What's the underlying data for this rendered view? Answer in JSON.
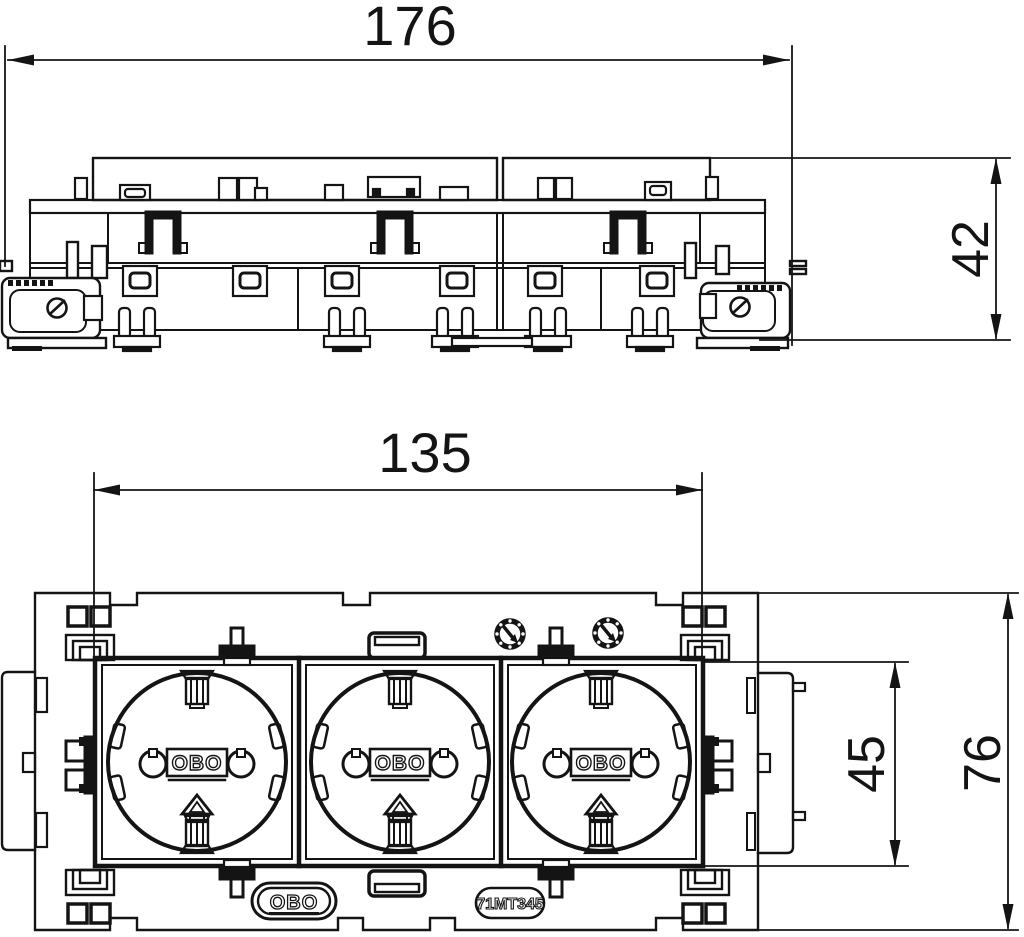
{
  "drawing": {
    "background_color": "#ffffff",
    "line_color": "#141414",
    "dimensions": {
      "overall_width": "176",
      "overall_height": "42",
      "insert_width": "135",
      "insert_height": "45",
      "front_height": "76"
    },
    "labels": {
      "socket_logo": "OBO",
      "brand_badge": "OBO",
      "part_number": "71MT345"
    },
    "icons": {
      "screw_head": "torx-screw-icon",
      "latch": "latch-clip-icon",
      "connector_slot": "connector-slot-icon",
      "corner_marker": "corner-marker-icon",
      "side_clip": "side-clip-icon",
      "earth_contact": "earth-contact-icon",
      "socket": "schuko-socket"
    }
  }
}
